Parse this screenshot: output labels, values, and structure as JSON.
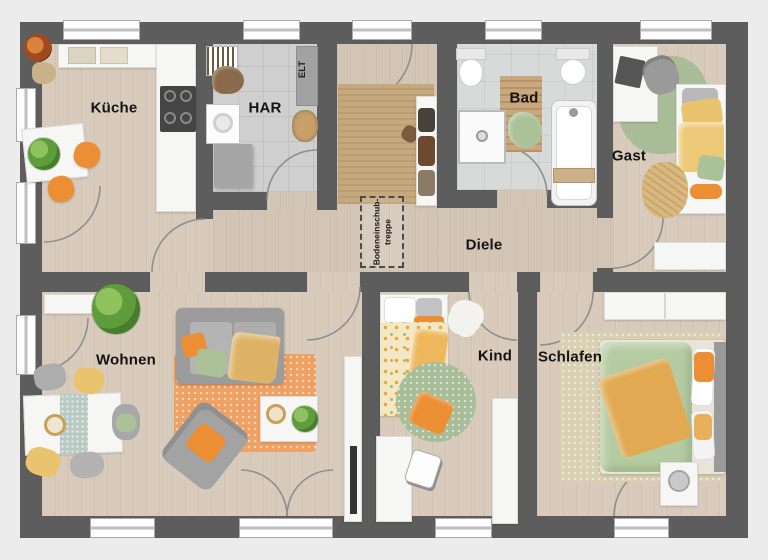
{
  "floorplan": {
    "rooms": {
      "kueche": {
        "label": "Küche"
      },
      "har": {
        "label": "HAR"
      },
      "bad": {
        "label": "Bad"
      },
      "gast": {
        "label": "Gast"
      },
      "diele": {
        "label": "Diele"
      },
      "wohnen": {
        "label": "Wohnen"
      },
      "kind": {
        "label": "Kind"
      },
      "schlafen": {
        "label": "Schlafen"
      }
    },
    "annotations": {
      "electrical": "ELT",
      "attic_hatch": {
        "line1": "Bodeneinschub-",
        "line2": "treppe"
      }
    },
    "colors": {
      "wall": "#5d5d5d",
      "outside": "#ececec",
      "wood": "#d8cbbc",
      "wood_hall": "#d3c5b5",
      "tile_har": "#cfcfcf",
      "tile_bad": "#d8dada",
      "accent_orange": "#ec8e33",
      "accent_yellow": "#e9c36d",
      "accent_green": "#abc298",
      "rug_tan": "#c5a87c",
      "rug_orange": "#efa163",
      "rug_green": "#a9bd99",
      "rug_beige": "#d9cfb2",
      "furniture_white": "#f6f6f4",
      "furniture_gray": "#a6a6a6",
      "door_arc": "#8f8f8f"
    }
  }
}
